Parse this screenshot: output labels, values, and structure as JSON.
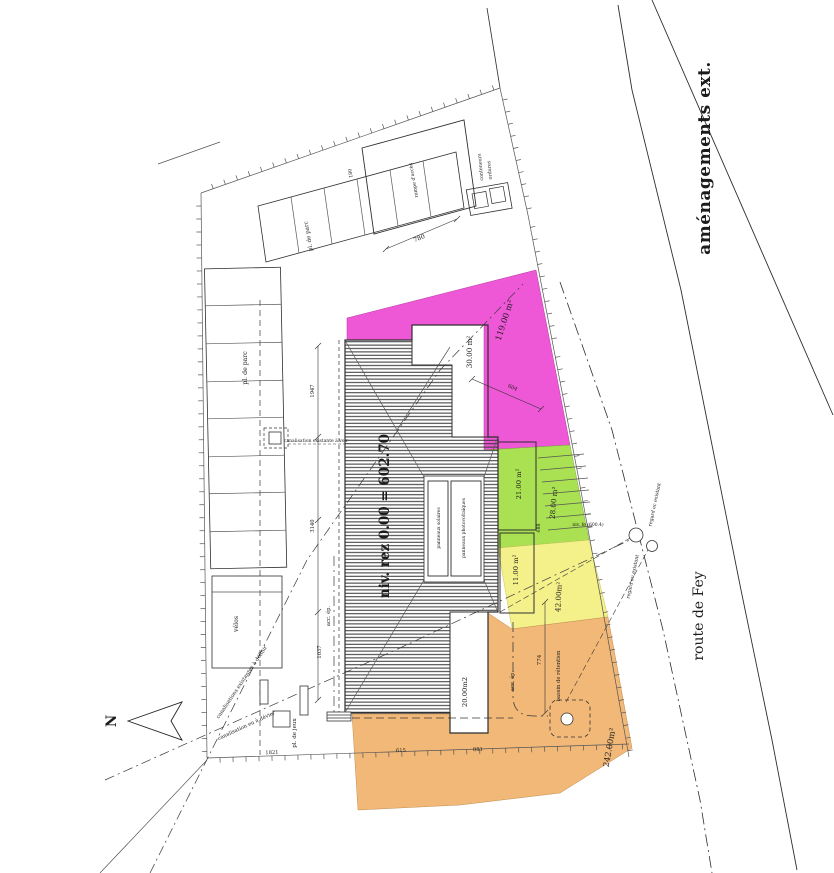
{
  "title": "aménagements ext.",
  "street": "route de Fey",
  "north_label": "N",
  "building": {
    "level": "niv. rez 0.00 = 602.70",
    "panel_left": "panneaux solaires",
    "panel_right": "panneaux photovoltaïques"
  },
  "zones": {
    "pink": {
      "area": "119.00 m²",
      "color": "#ee58d6"
    },
    "green": {
      "area": "28.00 m²",
      "color": "#a9e153"
    },
    "yellow": {
      "area": "42.00m²",
      "color": "#f4f08a"
    },
    "orange": {
      "area": "242.00m²",
      "color": "#f2b878"
    }
  },
  "terraces": {
    "upper": "30.00 m²",
    "mid": "21.00 m²",
    "low": "11.00 m²",
    "lower": "20.00m2"
  },
  "site": {
    "parking_left": "pl. de parc",
    "parking_top": "pl. de parc",
    "velos": "vélos",
    "jeux": "pl. de jeux",
    "containers_line1": "conteneurs",
    "containers_line2": "ordures",
    "ramp": "rampe d'accès",
    "bassin": "bassin de rétention",
    "acc_ep_1": "acc. ép.",
    "acc_ep_2": "acc. ép.",
    "regard_ec": "regard ec existant",
    "regard_eu": "regard eu existant",
    "note_upper": "canalisations existantes à définir",
    "note_lower": "canalisation eu à dévier",
    "note_hydrant": "canalisation existante à voir",
    "spot_level": "niv. fe (600.4)"
  },
  "dims": {
    "d780": "780",
    "d180": "180",
    "d1947": "1947",
    "d3140": "3140",
    "d1037": "1037",
    "d774": "774",
    "d688": "688",
    "d604": "604",
    "d1821": "1821",
    "d615": "615",
    "d881": "881"
  }
}
